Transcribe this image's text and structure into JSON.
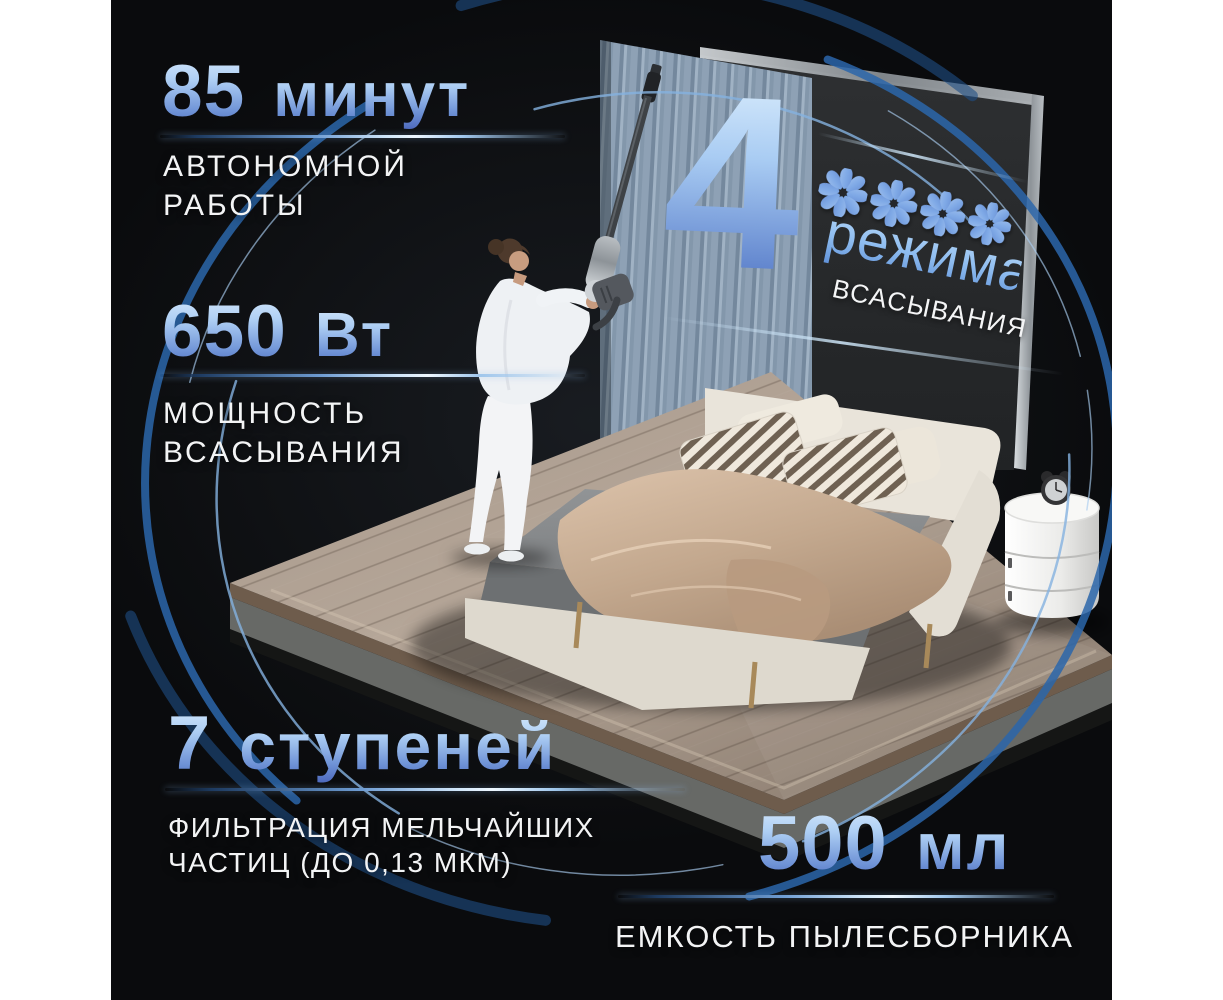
{
  "stats": [
    {
      "id": "battery-runtime",
      "value": "85",
      "unit": "минут",
      "label_line1": "АВТОНОМНОЙ",
      "label_line2": "РАБОТЫ"
    },
    {
      "id": "suction-power",
      "value": "650",
      "unit": "Вт",
      "label_line1": "МОЩНОСТЬ",
      "label_line2": "ВСАСЫВАНИЯ"
    },
    {
      "id": "filtration-stages",
      "value": "7",
      "unit": "ступеней",
      "label_line1": "ФИЛЬТРАЦИЯ МЕЛЬЧАЙШИХ",
      "label_line2": "ЧАСТИЦ (ДО 0,13 МКМ)"
    },
    {
      "id": "dustbin-capacity",
      "value": "500",
      "unit": "мл",
      "label_line1": "ЕМКОСТЬ ПЫЛЕСБОРНИКА",
      "label_line2": ""
    }
  ],
  "modes": {
    "count": "4",
    "word": "режима",
    "label": "ВСАСЫВАНИЯ",
    "fan_icon_count": 4
  },
  "colors": {
    "page_background": "#ffffff",
    "scene_background": "#08090b",
    "stat_gradient_top": "#dcedfd",
    "stat_gradient_bottom": "#4b66bb",
    "swirl_blue": "#2e6cb0",
    "label_white": "#f3f4f5"
  }
}
